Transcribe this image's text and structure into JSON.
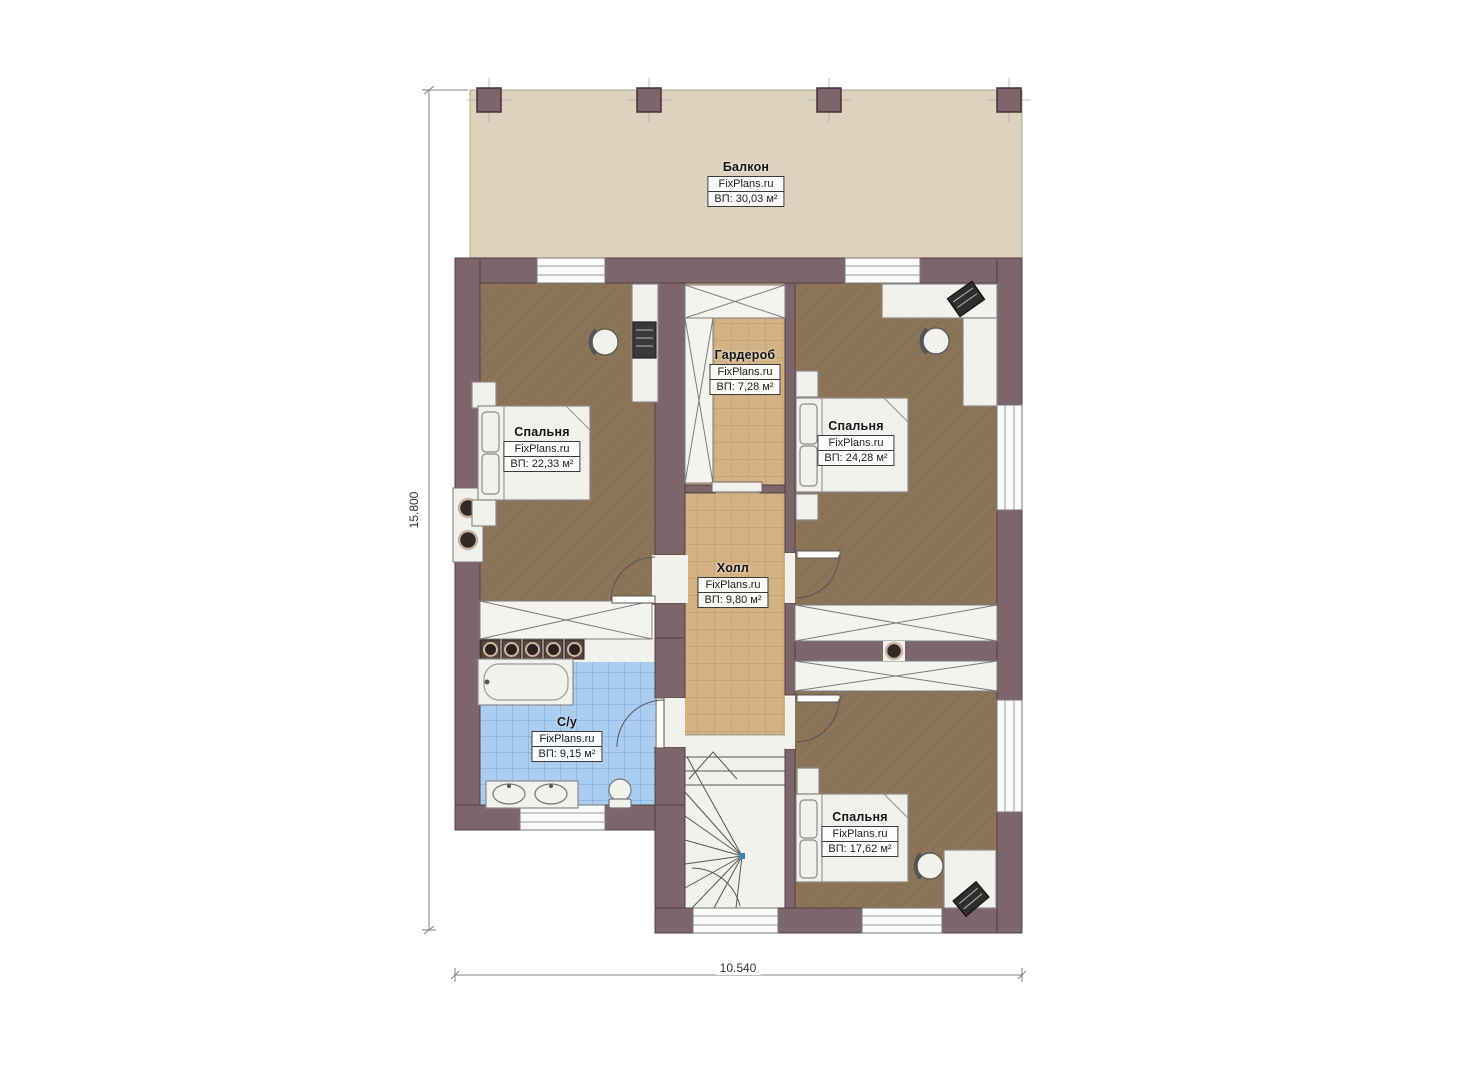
{
  "watermark": "FixPlans.ru",
  "dimensions": {
    "vertical": "15.800",
    "horizontal": "10.540"
  },
  "rooms": [
    {
      "name": "Балкон",
      "brand": "FixPlans.ru",
      "area": "ВП: 30,03 м²"
    },
    {
      "name": "Спальня",
      "brand": "FixPlans.ru",
      "area": "ВП: 22,33 м²"
    },
    {
      "name": "Гардероб",
      "brand": "FixPlans.ru",
      "area": "ВП: 7,28 м²"
    },
    {
      "name": "Спальня",
      "brand": "FixPlans.ru",
      "area": "ВП: 24,28 м²"
    },
    {
      "name": "Холл",
      "brand": "FixPlans.ru",
      "area": "ВП: 9,80 м²"
    },
    {
      "name": "С/у",
      "brand": "FixPlans.ru",
      "area": "ВП: 9,15 м²"
    },
    {
      "name": "Спальня",
      "brand": "FixPlans.ru",
      "area": "ВП: 17,62 м²"
    }
  ],
  "colors": {
    "wall": "#7c666b",
    "bedroom_floor": "#8b7458",
    "tile_floor": "#d3b385",
    "bath_floor": "#aacdf0",
    "balcony_floor": "#ddd2bd"
  }
}
